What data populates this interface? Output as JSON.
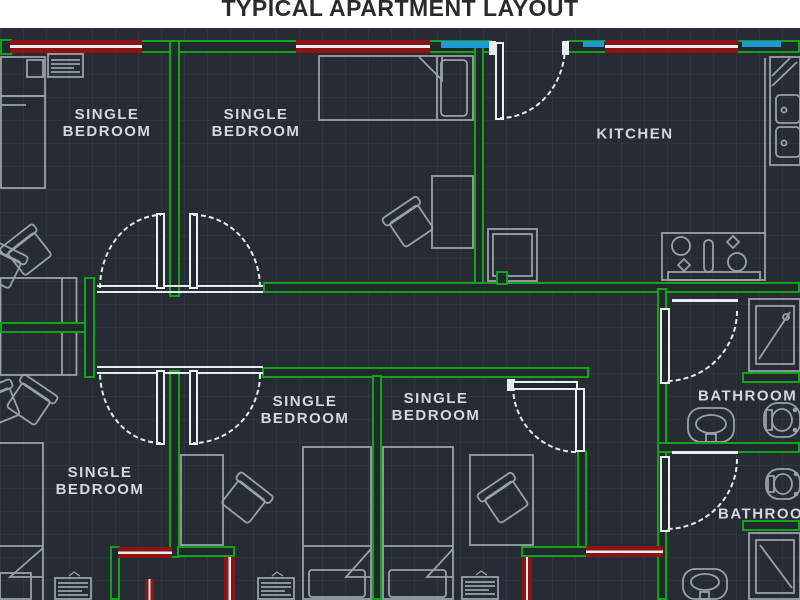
{
  "title": "TYPICAL APARTMENT LAYOUT",
  "rooms": {
    "bedroom_top_left": {
      "line1": "SINGLE",
      "line2": "BEDROOM"
    },
    "bedroom_top_middle": {
      "line1": "SINGLE",
      "line2": "BEDROOM"
    },
    "kitchen": {
      "label": "KITCHEN"
    },
    "bedroom_middle_left": {
      "line1": "SINGLE",
      "line2": "BEDROOM"
    },
    "bedroom_middle_right": {
      "line1": "SINGLE",
      "line2": "BEDROOM"
    },
    "bedroom_bottom_left": {
      "line1": "SINGLE",
      "line2": "BEDROOM"
    },
    "bathroom_upper": {
      "label": "BATHROOM"
    },
    "bathroom_lower": {
      "label": "BATHROOM"
    }
  },
  "colors": {
    "background": "#262b34",
    "wall_green": "#10a517",
    "window_red": "#8e1313",
    "window_blue": "#1f9ad4",
    "door_white": "#e9ecef",
    "furniture_gray": "#99a1a9",
    "label_gray": "#d3d8dd"
  }
}
